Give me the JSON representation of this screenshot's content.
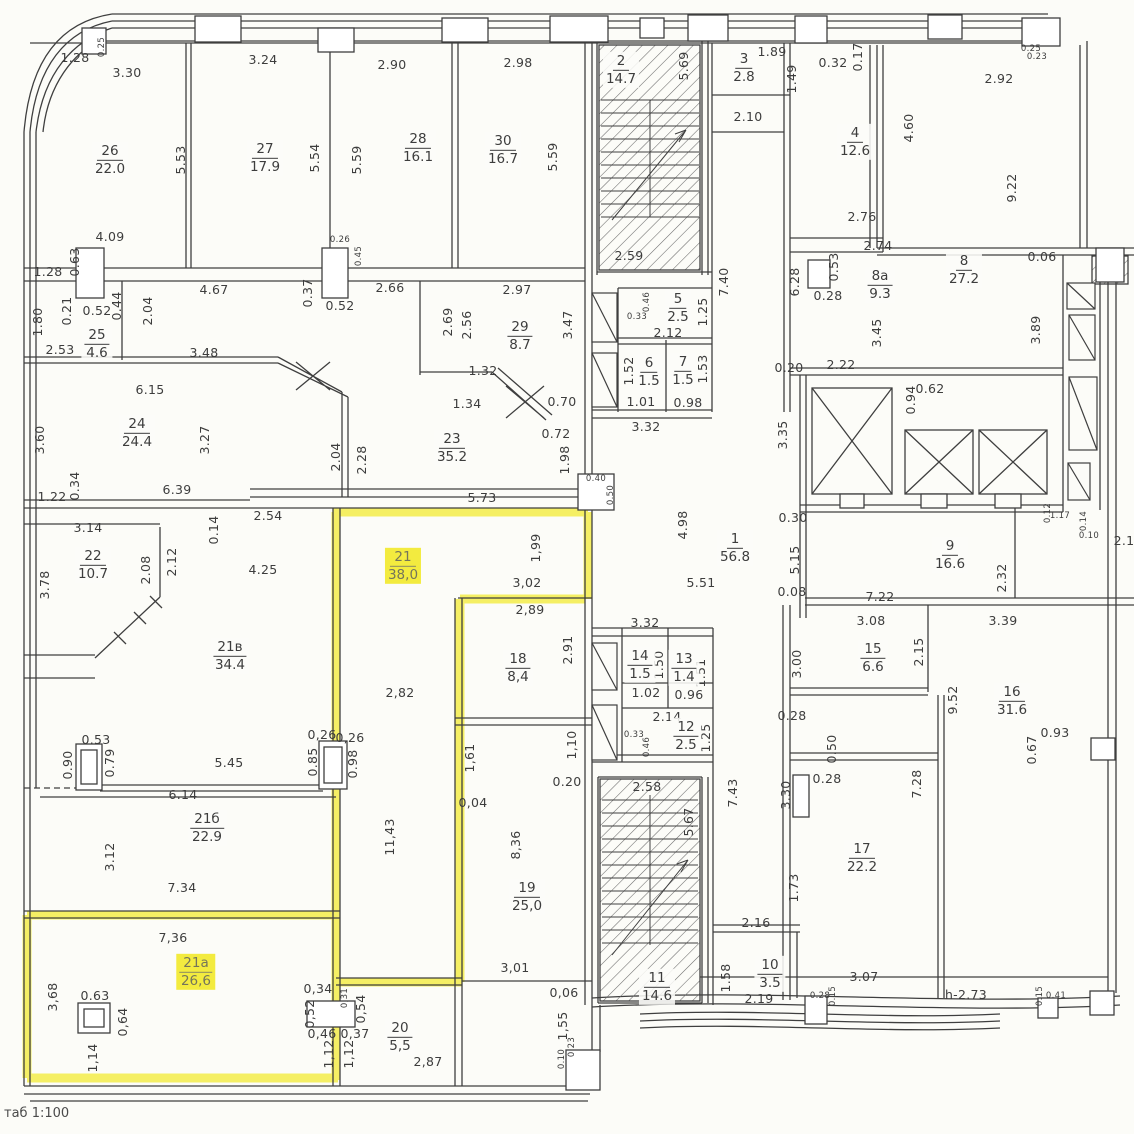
{
  "meta": {
    "drawing_type": "floor plan (scanned BTI plan)",
    "scale_note": "таб 1:100",
    "highlight_color": "#f3eb3f",
    "line_color": "#3f3f3f",
    "highlighted_units": [
      "21",
      "21а"
    ]
  },
  "note": {
    "text": "таб 1:100"
  },
  "rooms": [
    {
      "num": "26",
      "area": "22.0",
      "x": 110,
      "y": 160
    },
    {
      "num": "27",
      "area": "17.9",
      "x": 265,
      "y": 158
    },
    {
      "num": "28",
      "area": "16.1",
      "x": 418,
      "y": 148
    },
    {
      "num": "30",
      "area": "16.7",
      "x": 503,
      "y": 150
    },
    {
      "num": "2",
      "area": "14.7",
      "x": 621,
      "y": 70
    },
    {
      "num": "3",
      "area": "2.8",
      "x": 744,
      "y": 68
    },
    {
      "num": "4",
      "area": "12.6",
      "x": 855,
      "y": 142
    },
    {
      "num": "8а",
      "area": "9.3",
      "x": 880,
      "y": 285
    },
    {
      "num": "8",
      "area": "27.2",
      "x": 964,
      "y": 270
    },
    {
      "num": "25",
      "area": "4.6",
      "x": 97,
      "y": 344
    },
    {
      "num": "29",
      "area": "8.7",
      "x": 520,
      "y": 336
    },
    {
      "num": "5",
      "area": "2.5",
      "x": 678,
      "y": 308
    },
    {
      "num": "6",
      "area": "1.5",
      "x": 649,
      "y": 372
    },
    {
      "num": "7",
      "area": "1.5",
      "x": 683,
      "y": 371
    },
    {
      "num": "24",
      "area": "24.4",
      "x": 137,
      "y": 433
    },
    {
      "num": "23",
      "area": "35.2",
      "x": 452,
      "y": 448
    },
    {
      "num": "1",
      "area": "56.8",
      "x": 735,
      "y": 548
    },
    {
      "num": "22",
      "area": "10.7",
      "x": 93,
      "y": 565
    },
    {
      "num": "21",
      "area": "38,0",
      "x": 403,
      "y": 566,
      "hl": 1
    },
    {
      "num": "9",
      "area": "16.6",
      "x": 950,
      "y": 555
    },
    {
      "num": "21в",
      "area": "34.4",
      "x": 230,
      "y": 656
    },
    {
      "num": "18",
      "area": "8,4",
      "x": 518,
      "y": 668
    },
    {
      "num": "14",
      "area": "1.5",
      "x": 640,
      "y": 665
    },
    {
      "num": "13",
      "area": "1.4",
      "x": 684,
      "y": 668
    },
    {
      "num": "15",
      "area": "6.6",
      "x": 873,
      "y": 658
    },
    {
      "num": "16",
      "area": "31.6",
      "x": 1012,
      "y": 701
    },
    {
      "num": "12",
      "area": "2.5",
      "x": 686,
      "y": 736
    },
    {
      "num": "21б",
      "area": "22.9",
      "x": 207,
      "y": 828
    },
    {
      "num": "19",
      "area": "25,0",
      "x": 527,
      "y": 897
    },
    {
      "num": "17",
      "area": "22.2",
      "x": 862,
      "y": 858
    },
    {
      "num": "11",
      "area": "14.6",
      "x": 657,
      "y": 987
    },
    {
      "num": "10",
      "area": "3.5",
      "x": 770,
      "y": 974
    },
    {
      "num": "21а",
      "area": "26,6",
      "x": 196,
      "y": 972,
      "hl": 1
    },
    {
      "num": "20",
      "area": "5,5",
      "x": 400,
      "y": 1037
    }
  ],
  "dims": [
    {
      "t": "1.28",
      "x": 75,
      "y": 58
    },
    {
      "t": "0.25",
      "x": 102,
      "y": 47,
      "v": 1,
      "s": 1
    },
    {
      "t": "3.30",
      "x": 127,
      "y": 73
    },
    {
      "t": "3.24",
      "x": 263,
      "y": 60
    },
    {
      "t": "2.90",
      "x": 392,
      "y": 65
    },
    {
      "t": "2.98",
      "x": 518,
      "y": 63
    },
    {
      "t": "5.53",
      "x": 181,
      "y": 160,
      "v": 1
    },
    {
      "t": "5.54",
      "x": 315,
      "y": 158,
      "v": 1
    },
    {
      "t": "5.59",
      "x": 357,
      "y": 160,
      "v": 1
    },
    {
      "t": "5.59",
      "x": 553,
      "y": 157,
      "v": 1
    },
    {
      "t": "4.09",
      "x": 110,
      "y": 237
    },
    {
      "t": "0.26",
      "x": 340,
      "y": 240,
      "s": 1
    },
    {
      "t": "0.45",
      "x": 359,
      "y": 256,
      "v": 1,
      "s": 1
    },
    {
      "t": "1.28",
      "x": 48,
      "y": 272
    },
    {
      "t": "0.63",
      "x": 75,
      "y": 262,
      "v": 1
    },
    {
      "t": "4.67",
      "x": 214,
      "y": 290
    },
    {
      "t": "0.37",
      "x": 308,
      "y": 293,
      "v": 1
    },
    {
      "t": "0.52",
      "x": 340,
      "y": 306
    },
    {
      "t": "2.66",
      "x": 390,
      "y": 288
    },
    {
      "t": "2.97",
      "x": 517,
      "y": 290
    },
    {
      "t": "0.21",
      "x": 67,
      "y": 311,
      "v": 1
    },
    {
      "t": "0.52",
      "x": 97,
      "y": 311
    },
    {
      "t": "0.44",
      "x": 117,
      "y": 306,
      "v": 1
    },
    {
      "t": "2.04",
      "x": 148,
      "y": 311,
      "v": 1
    },
    {
      "t": "1.80",
      "x": 38,
      "y": 322,
      "v": 1
    },
    {
      "t": "2.53",
      "x": 60,
      "y": 350
    },
    {
      "t": "3.48",
      "x": 204,
      "y": 353
    },
    {
      "t": "2.69",
      "x": 448,
      "y": 322,
      "v": 1
    },
    {
      "t": "2.56",
      "x": 467,
      "y": 325,
      "v": 1
    },
    {
      "t": "3.47",
      "x": 568,
      "y": 325,
      "v": 1
    },
    {
      "t": "1.32",
      "x": 483,
      "y": 371
    },
    {
      "t": "1.34",
      "x": 467,
      "y": 404
    },
    {
      "t": "0.70",
      "x": 562,
      "y": 402
    },
    {
      "t": "6.15",
      "x": 150,
      "y": 390
    },
    {
      "t": "3.60",
      "x": 40,
      "y": 440,
      "v": 1
    },
    {
      "t": "3.27",
      "x": 205,
      "y": 440,
      "v": 1
    },
    {
      "t": "2.04",
      "x": 336,
      "y": 457,
      "v": 1
    },
    {
      "t": "2.28",
      "x": 362,
      "y": 460,
      "v": 1
    },
    {
      "t": "0.72",
      "x": 556,
      "y": 434
    },
    {
      "t": "1.98",
      "x": 565,
      "y": 460,
      "v": 1
    },
    {
      "t": "6.39",
      "x": 177,
      "y": 490
    },
    {
      "t": "0.34",
      "x": 75,
      "y": 486,
      "v": 1
    },
    {
      "t": "1.22",
      "x": 52,
      "y": 497
    },
    {
      "t": "5.73",
      "x": 482,
      "y": 498
    },
    {
      "t": "0.40",
      "x": 596,
      "y": 479,
      "s": 1
    },
    {
      "t": "0.50",
      "x": 611,
      "y": 495,
      "v": 1,
      "s": 1
    },
    {
      "t": "3.14",
      "x": 88,
      "y": 528
    },
    {
      "t": "0.14",
      "x": 214,
      "y": 530,
      "v": 1
    },
    {
      "t": "2.54",
      "x": 268,
      "y": 516
    },
    {
      "t": "3.78",
      "x": 45,
      "y": 585,
      "v": 1
    },
    {
      "t": "2.08",
      "x": 146,
      "y": 570,
      "v": 1
    },
    {
      "t": "2.12",
      "x": 172,
      "y": 562,
      "v": 1
    },
    {
      "t": "4.25",
      "x": 263,
      "y": 570
    },
    {
      "t": "1,99",
      "x": 536,
      "y": 548,
      "v": 1
    },
    {
      "t": "4.98",
      "x": 683,
      "y": 525,
      "v": 1
    },
    {
      "t": "0.30",
      "x": 793,
      "y": 518
    },
    {
      "t": "5.15",
      "x": 795,
      "y": 560,
      "v": 1
    },
    {
      "t": "5.51",
      "x": 701,
      "y": 583
    },
    {
      "t": "0.08",
      "x": 792,
      "y": 592
    },
    {
      "t": "7.22",
      "x": 880,
      "y": 597
    },
    {
      "t": "2.32",
      "x": 1002,
      "y": 578,
      "v": 1
    },
    {
      "t": "3,02",
      "x": 527,
      "y": 583
    },
    {
      "t": "2,89",
      "x": 530,
      "y": 610
    },
    {
      "t": "2.91",
      "x": 568,
      "y": 650,
      "v": 1
    },
    {
      "t": "2,82",
      "x": 400,
      "y": 693
    },
    {
      "t": "3.32",
      "x": 645,
      "y": 623
    },
    {
      "t": "1.50",
      "x": 659,
      "y": 665,
      "v": 1
    },
    {
      "t": "1.51",
      "x": 701,
      "y": 673,
      "v": 1
    },
    {
      "t": "1.02",
      "x": 646,
      "y": 693
    },
    {
      "t": "0.96",
      "x": 689,
      "y": 695
    },
    {
      "t": "2.14",
      "x": 667,
      "y": 717
    },
    {
      "t": "1.25",
      "x": 706,
      "y": 738,
      "v": 1
    },
    {
      "t": "0.33",
      "x": 634,
      "y": 735,
      "s": 1
    },
    {
      "t": "0.46",
      "x": 647,
      "y": 747,
      "v": 1,
      "s": 1
    },
    {
      "t": "1,10",
      "x": 572,
      "y": 745,
      "v": 1
    },
    {
      "t": "0.20",
      "x": 567,
      "y": 782
    },
    {
      "t": "3.00",
      "x": 797,
      "y": 664,
      "v": 1
    },
    {
      "t": "2.15",
      "x": 919,
      "y": 652,
      "v": 1
    },
    {
      "t": "3.08",
      "x": 871,
      "y": 621
    },
    {
      "t": "3.39",
      "x": 1003,
      "y": 621
    },
    {
      "t": "9.52",
      "x": 953,
      "y": 700,
      "v": 1
    },
    {
      "t": "0.28",
      "x": 792,
      "y": 716
    },
    {
      "t": "0.50",
      "x": 832,
      "y": 749,
      "v": 1
    },
    {
      "t": "0.28",
      "x": 827,
      "y": 779
    },
    {
      "t": "0.93",
      "x": 1055,
      "y": 733
    },
    {
      "t": "0.67",
      "x": 1032,
      "y": 750,
      "v": 1
    },
    {
      "t": "3.30",
      "x": 786,
      "y": 795,
      "v": 1
    },
    {
      "t": "7.28",
      "x": 917,
      "y": 784,
      "v": 1
    },
    {
      "t": "1.73",
      "x": 794,
      "y": 888,
      "v": 1
    },
    {
      "t": "3.07",
      "x": 864,
      "y": 977
    },
    {
      "t": "h-2.73",
      "x": 966,
      "y": 995
    },
    {
      "t": "0.15",
      "x": 1040,
      "y": 996,
      "v": 1,
      "s": 1
    },
    {
      "t": "0.41",
      "x": 1056,
      "y": 996,
      "s": 1
    },
    {
      "t": "0.28",
      "x": 820,
      "y": 996,
      "s": 1
    },
    {
      "t": "0.15",
      "x": 833,
      "y": 996,
      "v": 1,
      "s": 1
    },
    {
      "t": "2.16",
      "x": 756,
      "y": 923
    },
    {
      "t": "1.58",
      "x": 726,
      "y": 978,
      "v": 1
    },
    {
      "t": "2.19",
      "x": 759,
      "y": 999
    },
    {
      "t": "5.67",
      "x": 689,
      "y": 822,
      "v": 1
    },
    {
      "t": "2.58",
      "x": 647,
      "y": 787
    },
    {
      "t": "7.43",
      "x": 733,
      "y": 793,
      "v": 1
    },
    {
      "t": "0,06",
      "x": 564,
      "y": 993
    },
    {
      "t": "3,01",
      "x": 515,
      "y": 968
    },
    {
      "t": "8,36",
      "x": 516,
      "y": 845,
      "v": 1
    },
    {
      "t": "11,43",
      "x": 390,
      "y": 837,
      "v": 1
    },
    {
      "t": "0,04",
      "x": 473,
      "y": 803
    },
    {
      "t": "1,61",
      "x": 470,
      "y": 758,
      "v": 1
    },
    {
      "t": "0,26",
      "x": 322,
      "y": 735
    },
    {
      "t": "0,26",
      "x": 350,
      "y": 738
    },
    {
      "t": "0.85",
      "x": 313,
      "y": 762,
      "v": 1
    },
    {
      "t": "0.98",
      "x": 353,
      "y": 764,
      "v": 1
    },
    {
      "t": "0.53",
      "x": 96,
      "y": 740
    },
    {
      "t": "0.90",
      "x": 68,
      "y": 765,
      "v": 1
    },
    {
      "t": "0.79",
      "x": 110,
      "y": 763,
      "v": 1
    },
    {
      "t": "5.45",
      "x": 229,
      "y": 763
    },
    {
      "t": "6.14",
      "x": 183,
      "y": 795
    },
    {
      "t": "3.12",
      "x": 110,
      "y": 857,
      "v": 1
    },
    {
      "t": "7.34",
      "x": 182,
      "y": 888
    },
    {
      "t": "7,36",
      "x": 173,
      "y": 938
    },
    {
      "t": "3,68",
      "x": 53,
      "y": 997,
      "v": 1
    },
    {
      "t": "0.63",
      "x": 95,
      "y": 996
    },
    {
      "t": "0,64",
      "x": 123,
      "y": 1022,
      "v": 1
    },
    {
      "t": "1,14",
      "x": 93,
      "y": 1058,
      "v": 1
    },
    {
      "t": "0,34",
      "x": 318,
      "y": 989
    },
    {
      "t": "0,52",
      "x": 310,
      "y": 1014,
      "v": 1
    },
    {
      "t": "0,31",
      "x": 345,
      "y": 998,
      "v": 1,
      "s": 1
    },
    {
      "t": "0,54",
      "x": 361,
      "y": 1009,
      "v": 1
    },
    {
      "t": "0,46",
      "x": 322,
      "y": 1034
    },
    {
      "t": "0,37",
      "x": 355,
      "y": 1034
    },
    {
      "t": "1,12",
      "x": 329,
      "y": 1054,
      "v": 1
    },
    {
      "t": "1,12",
      "x": 349,
      "y": 1054,
      "v": 1
    },
    {
      "t": "2,87",
      "x": 428,
      "y": 1062
    },
    {
      "t": "1,55",
      "x": 563,
      "y": 1026,
      "v": 1
    },
    {
      "t": "0.23",
      "x": 572,
      "y": 1047,
      "v": 1,
      "s": 1
    },
    {
      "t": "0.10",
      "x": 562,
      "y": 1059,
      "v": 1,
      "s": 1
    },
    {
      "t": "5.69",
      "x": 684,
      "y": 66,
      "v": 1
    },
    {
      "t": "2.59",
      "x": 629,
      "y": 256
    },
    {
      "t": "7.40",
      "x": 724,
      "y": 282,
      "v": 1
    },
    {
      "t": "1.89",
      "x": 772,
      "y": 52
    },
    {
      "t": "1.49",
      "x": 792,
      "y": 79,
      "v": 1
    },
    {
      "t": "0.32",
      "x": 833,
      "y": 63
    },
    {
      "t": "0.17",
      "x": 858,
      "y": 57,
      "v": 1
    },
    {
      "t": "2.92",
      "x": 999,
      "y": 79
    },
    {
      "t": "0.25",
      "x": 1031,
      "y": 49,
      "s": 1
    },
    {
      "t": "0.23",
      "x": 1037,
      "y": 57,
      "s": 1
    },
    {
      "t": "2.10",
      "x": 748,
      "y": 117
    },
    {
      "t": "4.60",
      "x": 909,
      "y": 128,
      "v": 1
    },
    {
      "t": "9.22",
      "x": 1012,
      "y": 188,
      "v": 1
    },
    {
      "t": "2.76",
      "x": 862,
      "y": 217
    },
    {
      "t": "2.74",
      "x": 878,
      "y": 246
    },
    {
      "t": "0.53",
      "x": 834,
      "y": 267,
      "v": 1
    },
    {
      "t": "0.28",
      "x": 828,
      "y": 296
    },
    {
      "t": "6.28",
      "x": 795,
      "y": 282,
      "v": 1
    },
    {
      "t": "3.45",
      "x": 877,
      "y": 333,
      "v": 1
    },
    {
      "t": "2.22",
      "x": 841,
      "y": 365
    },
    {
      "t": "0.20",
      "x": 789,
      "y": 368
    },
    {
      "t": "0.06",
      "x": 1042,
      "y": 257
    },
    {
      "t": "3.89",
      "x": 1036,
      "y": 330,
      "v": 1
    },
    {
      "t": "0.62",
      "x": 930,
      "y": 389
    },
    {
      "t": "0.94",
      "x": 911,
      "y": 400,
      "v": 1
    },
    {
      "t": "3.35",
      "x": 783,
      "y": 435,
      "v": 1
    },
    {
      "t": "3.32",
      "x": 646,
      "y": 427
    },
    {
      "t": "2.12",
      "x": 668,
      "y": 333
    },
    {
      "t": "1.25",
      "x": 703,
      "y": 312,
      "v": 1
    },
    {
      "t": "0.46",
      "x": 647,
      "y": 302,
      "v": 1,
      "s": 1
    },
    {
      "t": "0.33",
      "x": 637,
      "y": 317,
      "s": 1
    },
    {
      "t": "1.52",
      "x": 629,
      "y": 371,
      "v": 1
    },
    {
      "t": "1.53",
      "x": 703,
      "y": 369,
      "v": 1
    },
    {
      "t": "1.01",
      "x": 641,
      "y": 402
    },
    {
      "t": "0.98",
      "x": 688,
      "y": 403
    },
    {
      "t": "0.12",
      "x": 1048,
      "y": 513,
      "v": 1,
      "s": 1
    },
    {
      "t": "1.17",
      "x": 1060,
      "y": 516,
      "s": 1
    },
    {
      "t": "0.14",
      "x": 1084,
      "y": 521,
      "v": 1,
      "s": 1
    },
    {
      "t": "0.10",
      "x": 1089,
      "y": 536,
      "s": 1
    },
    {
      "t": "2.1",
      "x": 1124,
      "y": 541
    }
  ]
}
